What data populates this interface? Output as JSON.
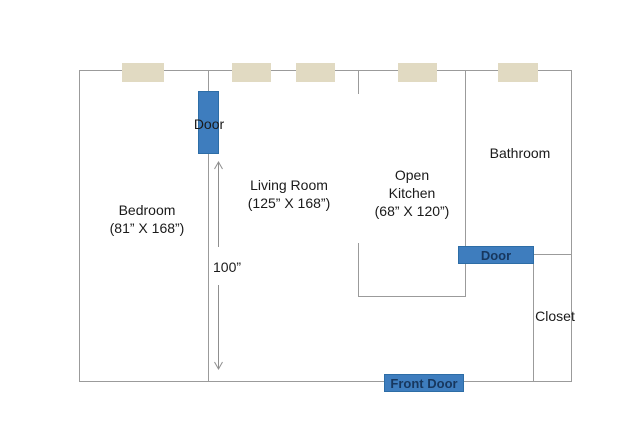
{
  "title": "Apartment floor plan",
  "colors": {
    "wall": "#9B9B9B",
    "window_fill": "#E1DAC2",
    "door_fill": "#3E7DBE",
    "door_border": "#2D6DA6",
    "door_text": "#17375E",
    "label_text": "#1A1A1A",
    "arrow": "#8F8F8F",
    "bg": "#FFFFFF"
  },
  "rooms": {
    "bedroom": {
      "name": "Bedroom",
      "dims": "(81” X 168”)"
    },
    "living": {
      "name": "Living Room",
      "dims": "(125” X 168”)"
    },
    "kitchen": {
      "line1": "Open",
      "line2": "Kitchen",
      "dims": "(68” X 120”)"
    },
    "bathroom": {
      "name": "Bathroom"
    },
    "closet": {
      "name": "Closet"
    }
  },
  "doors": {
    "bedroom_door": {
      "label": "Door"
    },
    "bathroom_door": {
      "label": "Door"
    },
    "front_door": {
      "label": "Front Door"
    }
  },
  "dimension": {
    "label": "100”"
  },
  "windows": {
    "count": 5
  }
}
